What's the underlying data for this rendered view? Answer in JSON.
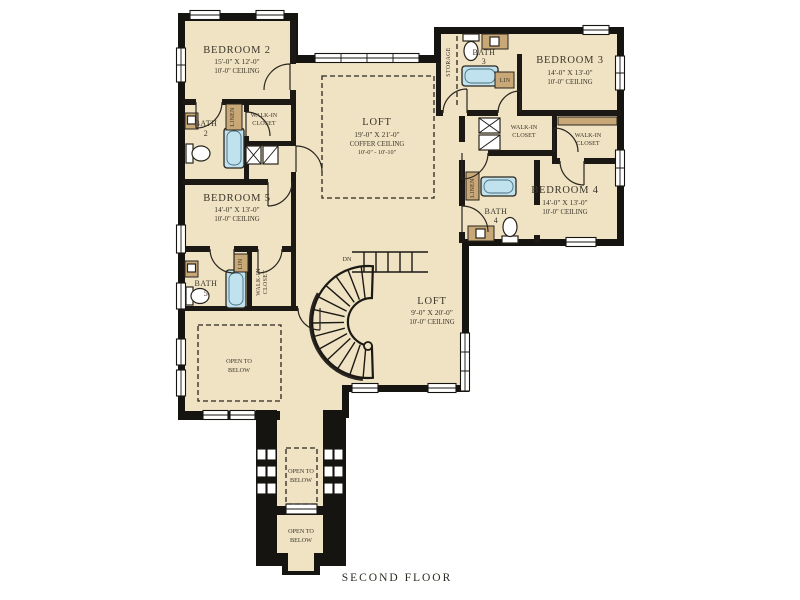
{
  "plan": {
    "caption": "SECOND FLOOR",
    "stair": {
      "down_label": "DN"
    },
    "rooms": {
      "bedroom2": {
        "name": "BEDROOM 2",
        "dims": "15'-0\" X 12'-0\"",
        "ceiling": "10'-0\" CEILING"
      },
      "bedroom3": {
        "name": "BEDROOM 3",
        "dims": "14'-0\" X 13'-0\"",
        "ceiling": "10'-0\" CEILING"
      },
      "bedroom4": {
        "name": "BEDROOM 4",
        "dims": "14'-0\" X 13'-0\"",
        "ceiling": "10'-0\" CEILING"
      },
      "bedroom5": {
        "name": "BEDROOM 5",
        "dims": "14'-0\" X 13'-0\"",
        "ceiling": "10'-0\" CEILING"
      },
      "loft_upper": {
        "name": "LOFT",
        "dims": "19'-0\" X 21'-0\"",
        "ceiling_type": "COFFER CEILING",
        "ceiling_range": "10'-0\" - 10'-10\""
      },
      "loft_lower": {
        "name": "LOFT",
        "dims": "9'-0\" X 20'-0\"",
        "ceiling": "10'-0\" CEILING"
      },
      "bath2": {
        "name": "BATH",
        "number": "2"
      },
      "bath3": {
        "name": "BATH",
        "number": "3"
      },
      "bath4": {
        "name": "BATH",
        "number": "4"
      },
      "bath5": {
        "name": "BATH",
        "number": "5"
      },
      "wic2": {
        "line1": "WALK-IN",
        "line2": "CLOSET"
      },
      "wic4a": {
        "line1": "WALK-IN",
        "line2": "CLOSET"
      },
      "wic4b": {
        "line1": "WALK-IN",
        "line2": "CLOSET"
      },
      "wic5": {
        "line1": "WALK-IN",
        "line2": "CLOSET"
      },
      "storage": {
        "name": "STORAGE"
      },
      "linen2": {
        "name": "LINEN"
      },
      "lin3": {
        "name": "LIN"
      },
      "lin4": {
        "name": "LINEN"
      },
      "lin5": {
        "name": "LIN"
      },
      "open_below_main": {
        "line1": "OPEN TO",
        "line2": "BELOW"
      },
      "open_below_balcony": {
        "line1": "OPEN TO",
        "line2": "BELOW"
      },
      "open_below_entry": {
        "line1": "OPEN TO",
        "line2": "BELOW"
      }
    },
    "colors": {
      "floor": "#efe3c3",
      "wall": "#161410",
      "cabinet": "#c9a878",
      "tub": "#bfe2ee"
    }
  }
}
